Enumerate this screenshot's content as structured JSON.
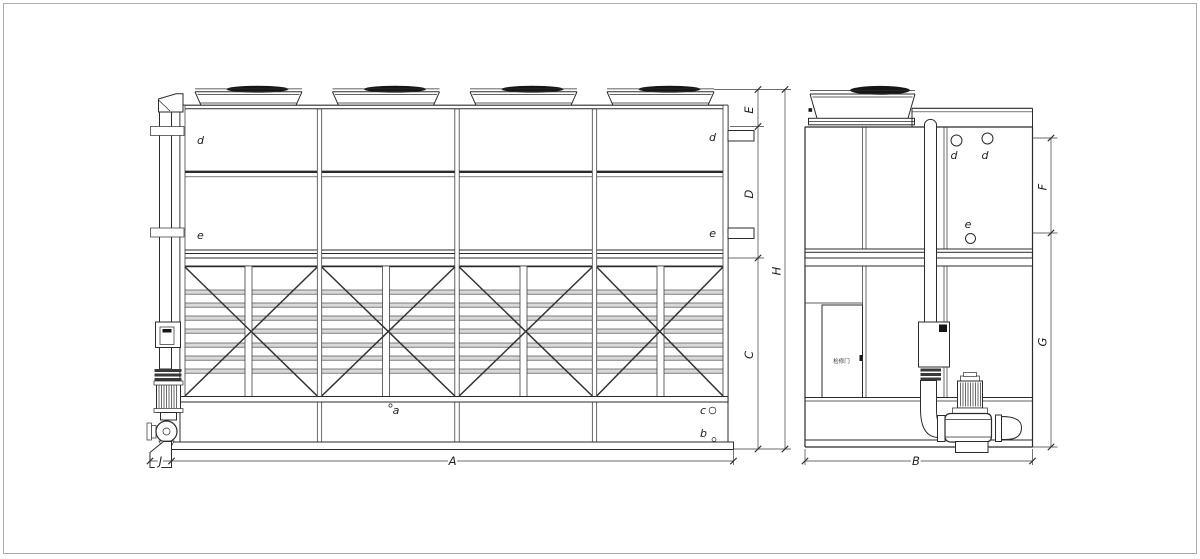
{
  "labels": {
    "dimensions": {
      "A": "A",
      "B": "B",
      "C": "C",
      "D": "D",
      "E": "E",
      "F": "F",
      "G": "G",
      "H": "H",
      "J": "J"
    },
    "parts": {
      "a": "a",
      "b": "b",
      "c": "c",
      "d": "d",
      "e": "e"
    },
    "annotations": {
      "access_door": "检修门"
    }
  },
  "colors": {
    "line": "#2b2b2b",
    "dimension_line": "#3a3a3a",
    "fan_cap": "#161616",
    "louver_fill": "#d9d9d9",
    "background": "#ffffff",
    "page_border": "#ababab"
  }
}
